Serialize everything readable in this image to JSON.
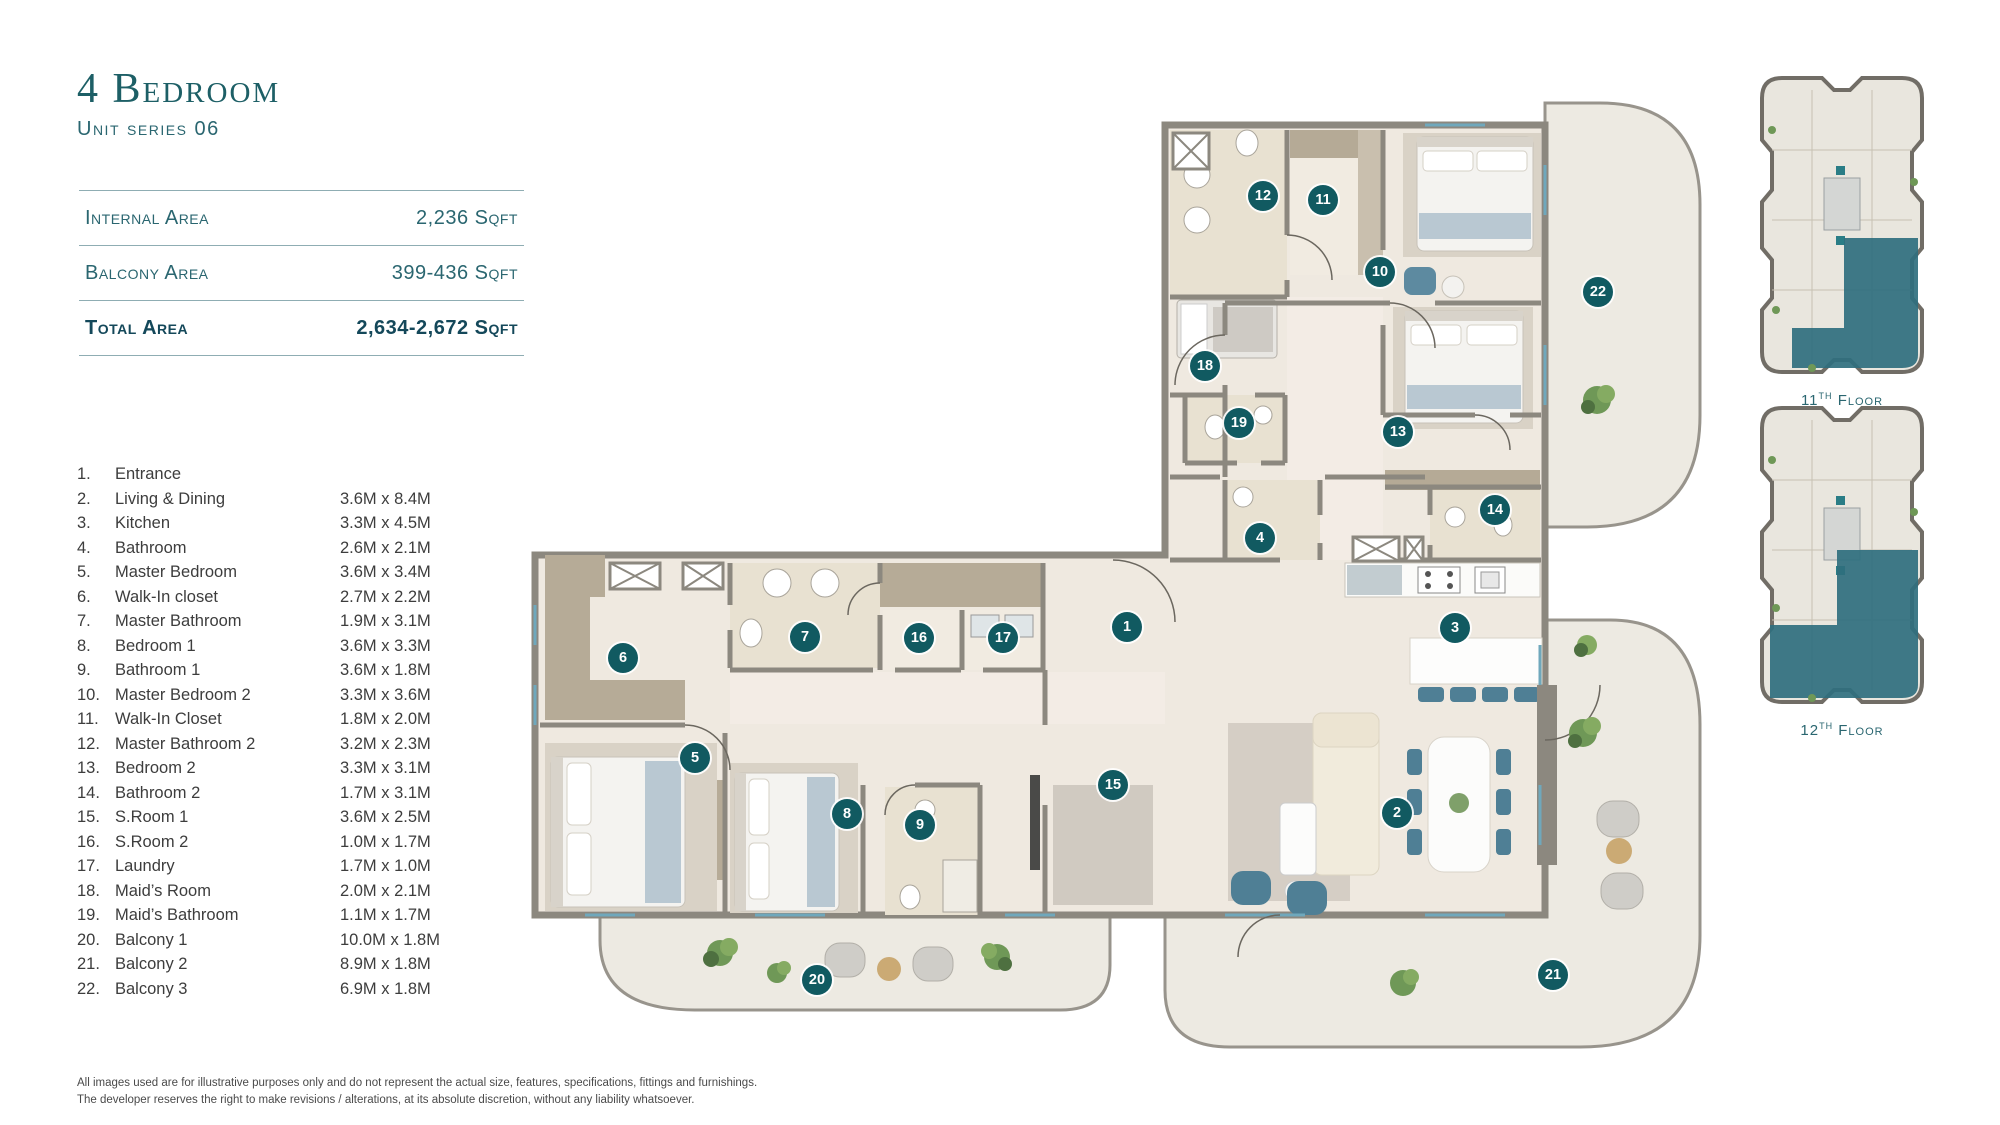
{
  "header": {
    "title": "4 Bedroom",
    "subtitle": "Unit series 06"
  },
  "area_table": {
    "rows": [
      {
        "label": "Internal Area",
        "value": "2,236 Sqft",
        "total": false
      },
      {
        "label": "Balcony Area",
        "value": "399-436 Sqft",
        "total": false
      },
      {
        "label": "Total Area",
        "value": "2,634-2,672 Sqft",
        "total": true
      }
    ]
  },
  "legend": {
    "items": [
      {
        "no": "1.",
        "name": "Entrance",
        "dims": ""
      },
      {
        "no": "2.",
        "name": "Living & Dining",
        "dims": "3.6M x 8.4M"
      },
      {
        "no": "3.",
        "name": "Kitchen",
        "dims": "3.3M x 4.5M"
      },
      {
        "no": "4.",
        "name": "Bathroom",
        "dims": "2.6M x 2.1M"
      },
      {
        "no": "5.",
        "name": "Master Bedroom",
        "dims": "3.6M x 3.4M"
      },
      {
        "no": "6.",
        "name": "Walk-In closet",
        "dims": "2.7M x 2.2M"
      },
      {
        "no": "7.",
        "name": "Master Bathroom",
        "dims": "1.9M x 3.1M"
      },
      {
        "no": "8.",
        "name": "Bedroom 1",
        "dims": "3.6M x 3.3M"
      },
      {
        "no": "9.",
        "name": "Bathroom 1",
        "dims": "3.6M x 1.8M"
      },
      {
        "no": "10.",
        "name": "Master Bedroom 2",
        "dims": "3.3M x 3.6M"
      },
      {
        "no": "11.",
        "name": "Walk-In Closet",
        "dims": "1.8M x 2.0M"
      },
      {
        "no": "12.",
        "name": "Master Bathroom 2",
        "dims": "3.2M x 2.3M"
      },
      {
        "no": "13.",
        "name": "Bedroom 2",
        "dims": "3.3M x 3.1M"
      },
      {
        "no": "14.",
        "name": "Bathroom 2",
        "dims": "1.7M x 3.1M"
      },
      {
        "no": "15.",
        "name": "S.Room 1",
        "dims": "3.6M x 2.5M"
      },
      {
        "no": "16.",
        "name": "S.Room 2",
        "dims": "1.0M x 1.7M"
      },
      {
        "no": "17.",
        "name": "Laundry",
        "dims": "1.7M x 1.0M"
      },
      {
        "no": "18.",
        "name": "Maid’s Room",
        "dims": "2.0M x 2.1M"
      },
      {
        "no": "19.",
        "name": "Maid’s Bathroom",
        "dims": "1.1M x 1.7M"
      },
      {
        "no": "20.",
        "name": "Balcony 1",
        "dims": "10.0M x 1.8M"
      },
      {
        "no": "21.",
        "name": "Balcony 2",
        "dims": "8.9M x 1.8M"
      },
      {
        "no": "22.",
        "name": "Balcony 3",
        "dims": "6.9M x 1.8M"
      }
    ]
  },
  "floor_plan": {
    "badges": [
      {
        "n": "1",
        "x": 602,
        "y": 542
      },
      {
        "n": "2",
        "x": 872,
        "y": 728
      },
      {
        "n": "3",
        "x": 930,
        "y": 543
      },
      {
        "n": "4",
        "x": 735,
        "y": 453
      },
      {
        "n": "5",
        "x": 170,
        "y": 673
      },
      {
        "n": "6",
        "x": 98,
        "y": 573
      },
      {
        "n": "7",
        "x": 280,
        "y": 552
      },
      {
        "n": "8",
        "x": 322,
        "y": 729
      },
      {
        "n": "9",
        "x": 395,
        "y": 740
      },
      {
        "n": "10",
        "x": 855,
        "y": 187
      },
      {
        "n": "11",
        "x": 798,
        "y": 115
      },
      {
        "n": "12",
        "x": 738,
        "y": 111
      },
      {
        "n": "13",
        "x": 873,
        "y": 347
      },
      {
        "n": "14",
        "x": 970,
        "y": 425
      },
      {
        "n": "15",
        "x": 588,
        "y": 700
      },
      {
        "n": "16",
        "x": 394,
        "y": 553
      },
      {
        "n": "17",
        "x": 478,
        "y": 553
      },
      {
        "n": "18",
        "x": 680,
        "y": 281
      },
      {
        "n": "19",
        "x": 714,
        "y": 338
      },
      {
        "n": "20",
        "x": 292,
        "y": 895
      },
      {
        "n": "21",
        "x": 1028,
        "y": 890
      },
      {
        "n": "22",
        "x": 1073,
        "y": 207
      }
    ]
  },
  "key_plans": {
    "first": {
      "num": "11",
      "sup": "TH",
      "word": "Floor"
    },
    "second": {
      "num": "12",
      "sup": "TH",
      "word": "Floor"
    }
  },
  "disclaimer": {
    "line1": "All images used are for illustrative purposes only and do not represent the actual size, features, specifications, fittings and furnishings.",
    "line2": "The developer reserves the right to make revisions / alterations, at its absolute discretion, without any liability whatsoever."
  },
  "colors": {
    "accent_teal": "#1d5f66",
    "badge": "#115a61",
    "wall": "#8c887f",
    "floor": "#efe9e0",
    "balcony": "#edeae2",
    "furniture_teal": "#4f7f95",
    "highlight": "#2f6f7e"
  }
}
